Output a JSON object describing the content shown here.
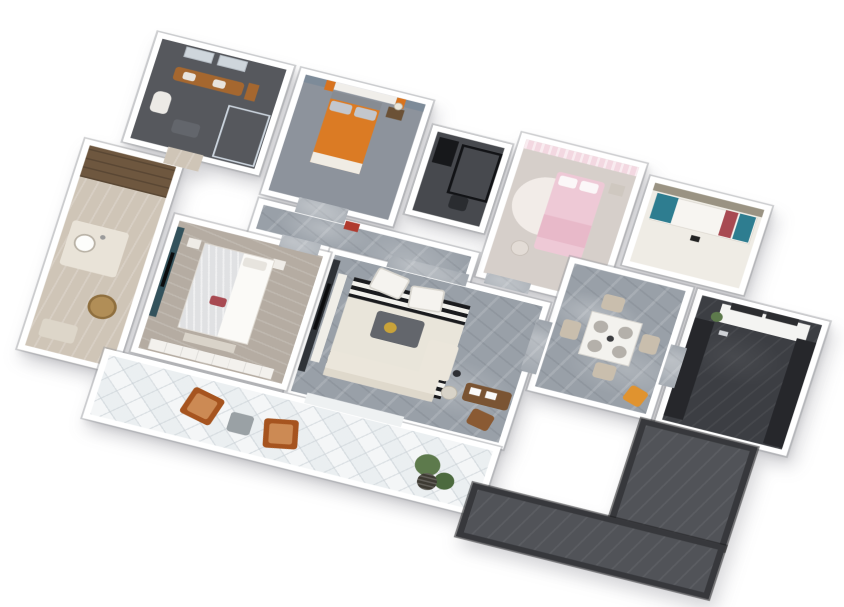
{
  "scene": {
    "type": "3d-floorplan-axonometric-render",
    "background": "#ffffff",
    "description": "Bird's-eye 3D rendering of a furnished apartment: marble living/dining core, four bedrooms/studies, two bathrooms, dark galley kitchen, L-shaped dark entry corridor and a long white-tiled balcony with lounge chairs"
  },
  "palette": {
    "wall": "#ffffff",
    "dark_wall": "#37383c",
    "marble_floor": "#99a0a8",
    "dark_kitchen_floor": "#3c3e43",
    "corridor_floor": "#515358",
    "balcony_tile": "#f4f6f7",
    "beige_floor": "#cfc5b7",
    "bedroom_wood_floor": "#b5aca2",
    "accents": {
      "orange_bed": "#db7b24",
      "orange_bed_foot": "#f0ece4",
      "gray_pillow": "#c3c7cd",
      "orange_curtain": "#d8731e",
      "blue_gray_wall": "#7d8b99",
      "pink_bed": "#eec9d6",
      "pink_blanket": "#e8b9c9",
      "pink_curtain": "#f3d8e1",
      "teal_cushion": "#2e7d90",
      "red_cushion": "#a84a52",
      "khaki_wall": "#9a9383",
      "teal_wall": "#33525c",
      "rust_chair": "#a6541f",
      "rust_cushion": "#cc8a54",
      "yellow_chair": "#e0932f",
      "wood_vanity": "#a5672f",
      "cabinet_brown": "#6e573f",
      "rattan_stool": "#b18e57",
      "desk_brown": "#7a5433",
      "chair_brown": "#8a5a33",
      "gold_tray": "#c9a33a",
      "red_art": "#b03a2e",
      "plant_green": "#5d7a4c",
      "sofa_cream": "#ebe6db",
      "rug_black": "#1a1b1e",
      "rug_white": "#f2f1ec"
    }
  },
  "rooms": [
    {
      "id": "dressing",
      "label": "Dressing / Laundry Room",
      "floor": "#cfc5b7",
      "furniture": [
        "wood cabinet run",
        "counter with round sink",
        "rattan stool",
        "floor mat"
      ]
    },
    {
      "id": "master-bath",
      "label": "Master Bathroom",
      "floor": "#56585d",
      "furniture": [
        "twin mirrors",
        "wood vanity with two sinks",
        "orange towel",
        "glass shower",
        "toilet",
        "bath mat"
      ]
    },
    {
      "id": "orange-bedroom",
      "label": "Bedroom with Orange Bed",
      "floor": "#8d939c",
      "furniture": [
        "window with orange curtains",
        "blue-gray accent wall",
        "orange double bed",
        "gray pillows",
        "nightstand with lamp"
      ]
    },
    {
      "id": "study-nook",
      "label": "Black-Frame Study Nook",
      "floor": "#47494e",
      "furniture": [
        "black metal desk frame",
        "black shelf",
        "chair"
      ]
    },
    {
      "id": "pink-bedroom",
      "label": "Pink Bedroom",
      "floor": "#d6cfca",
      "furniture": [
        "pink curtains",
        "round rug",
        "pink bed with white pillows",
        "nightstand",
        "stool"
      ]
    },
    {
      "id": "study-room",
      "label": "Study / Daybed Room",
      "floor": "#efece5",
      "furniture": [
        "khaki feature wall",
        "long white bench",
        "teal cushions",
        "red cushion",
        "phone"
      ]
    },
    {
      "id": "kitchen",
      "label": "Kitchen",
      "floor": "#3c3e43",
      "furniture": [
        "window counter",
        "black window frames",
        "green plant",
        "dark galley counters"
      ]
    },
    {
      "id": "dining",
      "label": "Dining Area",
      "floor": "#99a0a8",
      "furniture": [
        "square dining table",
        "four place settings",
        "four beige chairs",
        "yellow accent chair"
      ]
    },
    {
      "id": "hallway",
      "label": "Hallway",
      "floor": "#99a0a8",
      "furniture": [
        "red wall artwork"
      ]
    },
    {
      "id": "living",
      "label": "Living Room",
      "floor": "#99a0a8",
      "furniture": [
        "media wall with TV",
        "white console",
        "striped black-white rug",
        "two white armchairs",
        "gray coffee table with gold tray",
        "cream L-shaped sofa",
        "side table",
        "floor lamp",
        "brown desk with papers",
        "brown desk chair"
      ]
    },
    {
      "id": "master-bedroom",
      "label": "Master Bedroom",
      "floor": "#b5aca2",
      "furniture": [
        "teal accent wall with TV",
        "canopy bed with sheer drape",
        "red accent pillow",
        "nightstands",
        "foot bench",
        "white wardrobe"
      ]
    },
    {
      "id": "balcony",
      "label": "Balcony",
      "floor": "#f4f6f7",
      "furniture": [
        "two rust lounge chairs",
        "gray cube table",
        "potted plants",
        "woven basket"
      ]
    },
    {
      "id": "corridor-v",
      "label": "Entry Corridor (vertical leg)",
      "floor": "#515358",
      "furniture": []
    },
    {
      "id": "corridor-h",
      "label": "Entry Corridor (lower leg)",
      "floor": "#515358",
      "furniture": []
    }
  ]
}
